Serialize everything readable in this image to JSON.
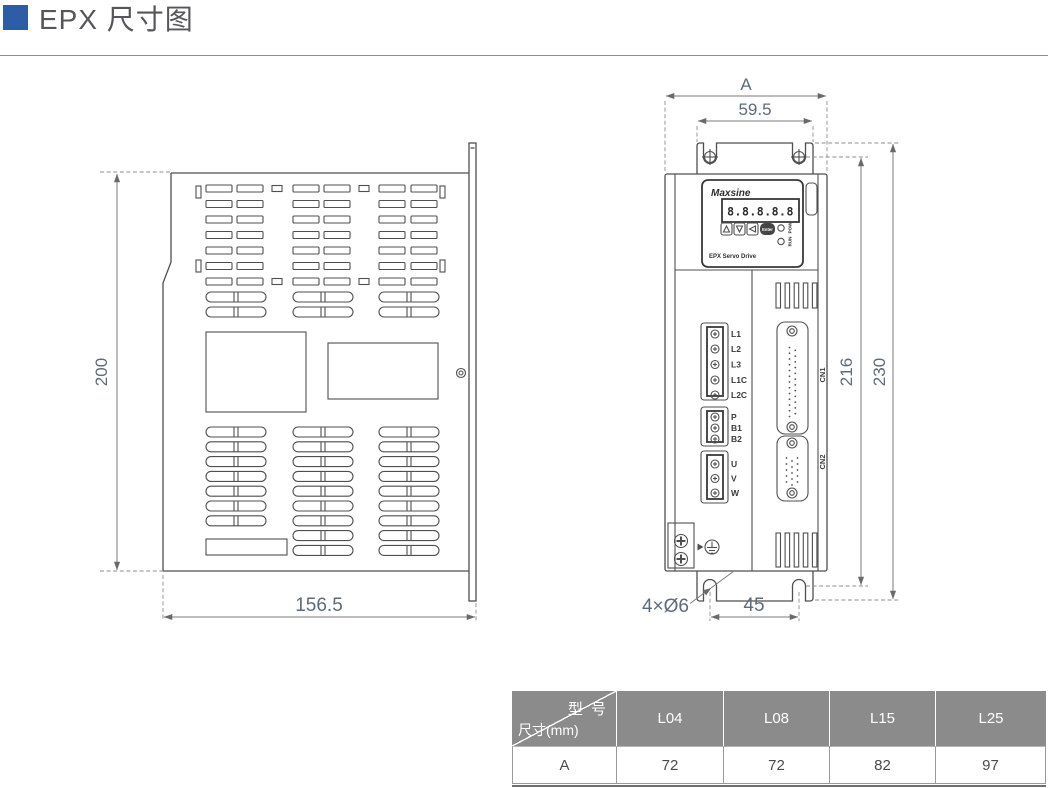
{
  "header": {
    "title": "EPX 尺寸图"
  },
  "side_view": {
    "dim_height": "200",
    "dim_width": "156.5"
  },
  "front_view": {
    "dim_overall_width": "A",
    "dim_mount_width": "59.5",
    "dim_mount_height": "216",
    "dim_overall_height": "230",
    "dim_hole_span": "45",
    "dim_holes": "4×Ø6",
    "panel": {
      "brand": "Maxsine",
      "display": "8.8.8.8.8",
      "enter_label": "Enter",
      "led_top": "POW",
      "led_bottom": "RUN",
      "caption": "EPX Servo Drive"
    },
    "terminals_power": [
      "L1",
      "L2",
      "L3",
      "L1C",
      "L2C"
    ],
    "terminals_brake": [
      "P",
      "B1",
      "B2"
    ],
    "terminals_motor": [
      "U",
      "V",
      "W"
    ],
    "connector_top": "CN1",
    "connector_bottom": "CN2"
  },
  "table": {
    "corner_top_right": "型 号",
    "corner_bottom_left": "尺寸(mm)",
    "columns": [
      "L04",
      "L08",
      "L15",
      "L25"
    ],
    "row_label": "A",
    "values": [
      "72",
      "72",
      "82",
      "97"
    ]
  }
}
